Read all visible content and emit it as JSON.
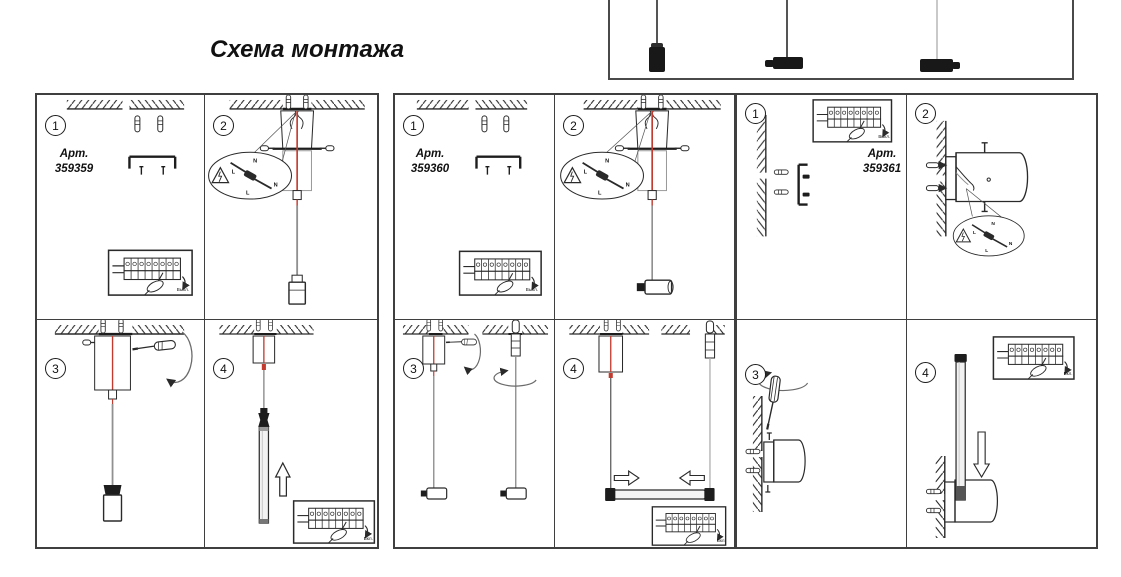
{
  "title": "Схема монтажа",
  "labels": {
    "switch_off": "Выкл.",
    "switch_on": "Вкл.",
    "wire_n": "N",
    "wire_l": "L"
  },
  "panels": [
    {
      "art_label": "Арт.",
      "art_number": "359359",
      "steps": [
        "1",
        "2",
        "3",
        "4"
      ]
    },
    {
      "art_label": "Арт.",
      "art_number": "359360",
      "steps": [
        "1",
        "2",
        "3",
        "4"
      ]
    },
    {
      "art_label": "Арт.",
      "art_number": "359361",
      "steps": [
        "1",
        "2",
        "3",
        "4"
      ]
    }
  ],
  "product_box": {
    "pendant_count": "3"
  },
  "colors": {
    "cable_red": "#c23b2e",
    "line": "#2a2a2a"
  }
}
